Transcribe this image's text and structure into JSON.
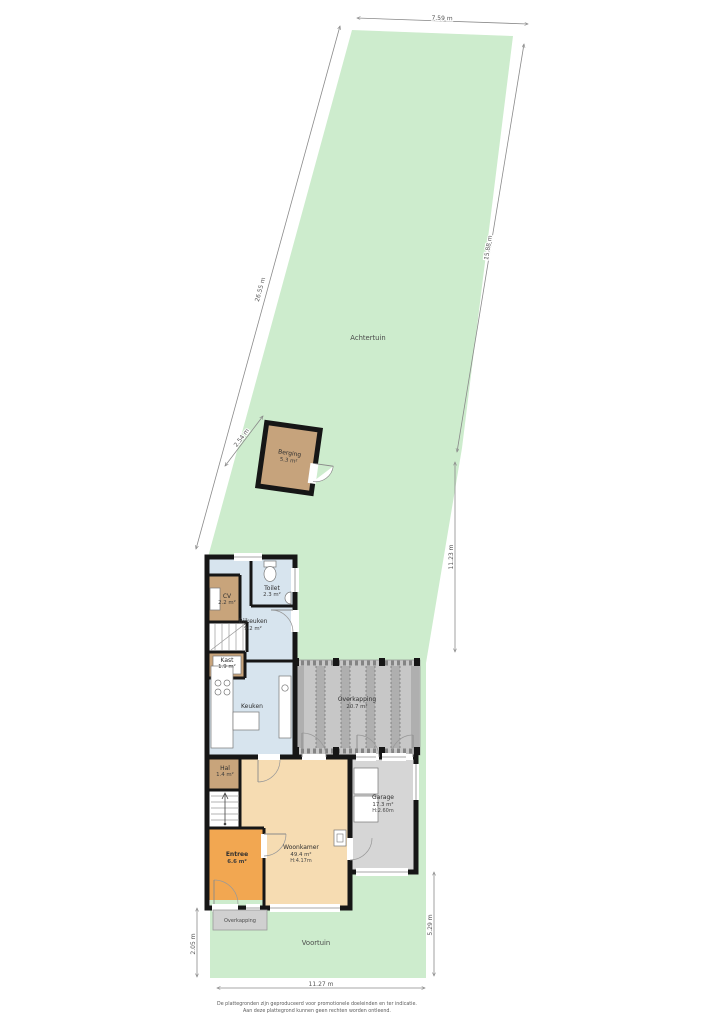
{
  "garden": {
    "back_label": "Achtertuin",
    "front_label": "Voortuin"
  },
  "shed": {
    "name": "Berging",
    "area": "5.3 m²"
  },
  "rooms": {
    "bijkeuken": {
      "name": "Bijkeuken",
      "area": "9.2 m²"
    },
    "cv": {
      "name": "CV",
      "area": "2.2 m²"
    },
    "toilet": {
      "name": "Toilet",
      "area": "2.3 m²"
    },
    "kast": {
      "name": "Kast",
      "area": "1.9 m²"
    },
    "keuken": {
      "name": "Keuken"
    },
    "overkapping_rear": {
      "name": "Overkapping",
      "area": "20.7 m²"
    },
    "hal": {
      "name": "Hal",
      "area": "1.4 m²"
    },
    "entree": {
      "name": "Entree",
      "area": "6.6 m²"
    },
    "woonkamer": {
      "name": "Woonkamer",
      "area": "49.4 m²",
      "height": "H:4.17m"
    },
    "garage": {
      "name": "Garage",
      "area": "17.3 m²",
      "height": "H:2.60m"
    },
    "overkapping_front": {
      "name": "Overkapping"
    }
  },
  "dimensions": {
    "top": "7.59 m",
    "left_back": "26.55 m",
    "right_back": "15.88 m",
    "shed_offset": "2.54 m",
    "right_mid": "11.23 m",
    "bottom": "11.27 m",
    "front_left": "2.05 m",
    "front_right": "5.29 m"
  },
  "footer": {
    "line1": "De plattegronden zijn geproduceerd voor promotionele doeleinden en ter indicatie.",
    "line2": "Aan deze plattegrond kunnen geen rechten worden ontleend."
  },
  "colors": {
    "garden": "#cdeccd",
    "room_blue": "#d7e4ee",
    "room_tan": "#c8a47b",
    "room_orange": "#f2a751",
    "room_beige": "#f6dcb2",
    "room_gray": "#d6d6d6",
    "terrace_gray": "#c7c7c7",
    "wall": "#161616"
  }
}
